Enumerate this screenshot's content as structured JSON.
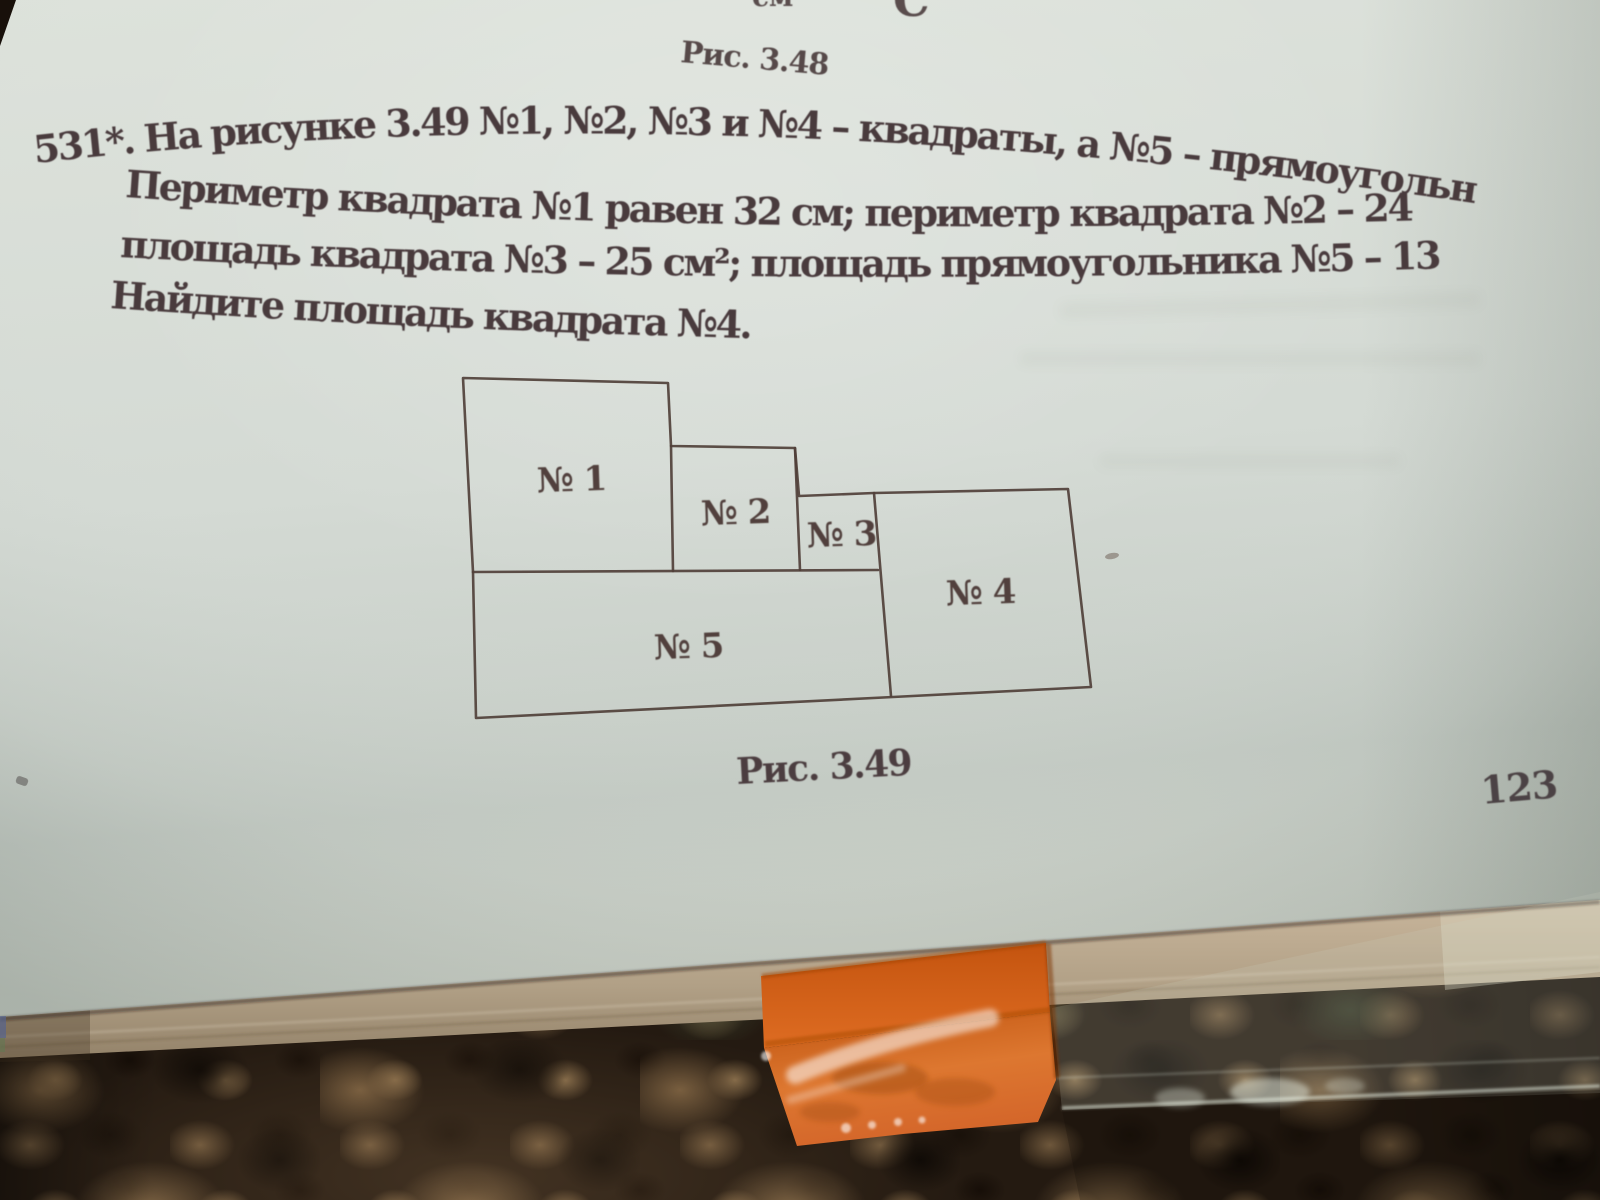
{
  "page": {
    "fragment_top_left": "см",
    "fragment_top_right": "C",
    "figure_above_caption": "Рис. 3.48",
    "problem": {
      "line1": "531*. На рисунке 3.49 №1, №2, №3 и №4 – квадраты, а №5 – прямоугольник.",
      "line2": "Периметр квадрата №1 равен 32 см; периметр квадрата №2 – 24 см;",
      "line3": "площадь квадрата №3 – 25 см²; площадь прямоугольника №5 – 133 см².",
      "line4": "Найдите площадь квадрата №4."
    },
    "figure": {
      "caption": "Рис. 3.49",
      "labels": [
        "№ 1",
        "№ 2",
        "№ 3",
        "№ 4",
        "№ 5"
      ]
    },
    "page_number": "123"
  },
  "colors": {
    "ink": "#493b3d",
    "figure_line": "#50403a",
    "page": "#d6dbd4",
    "book_edge": "#b3a088",
    "tape_orange": "#d2591a",
    "table_dark": "#241a11"
  }
}
